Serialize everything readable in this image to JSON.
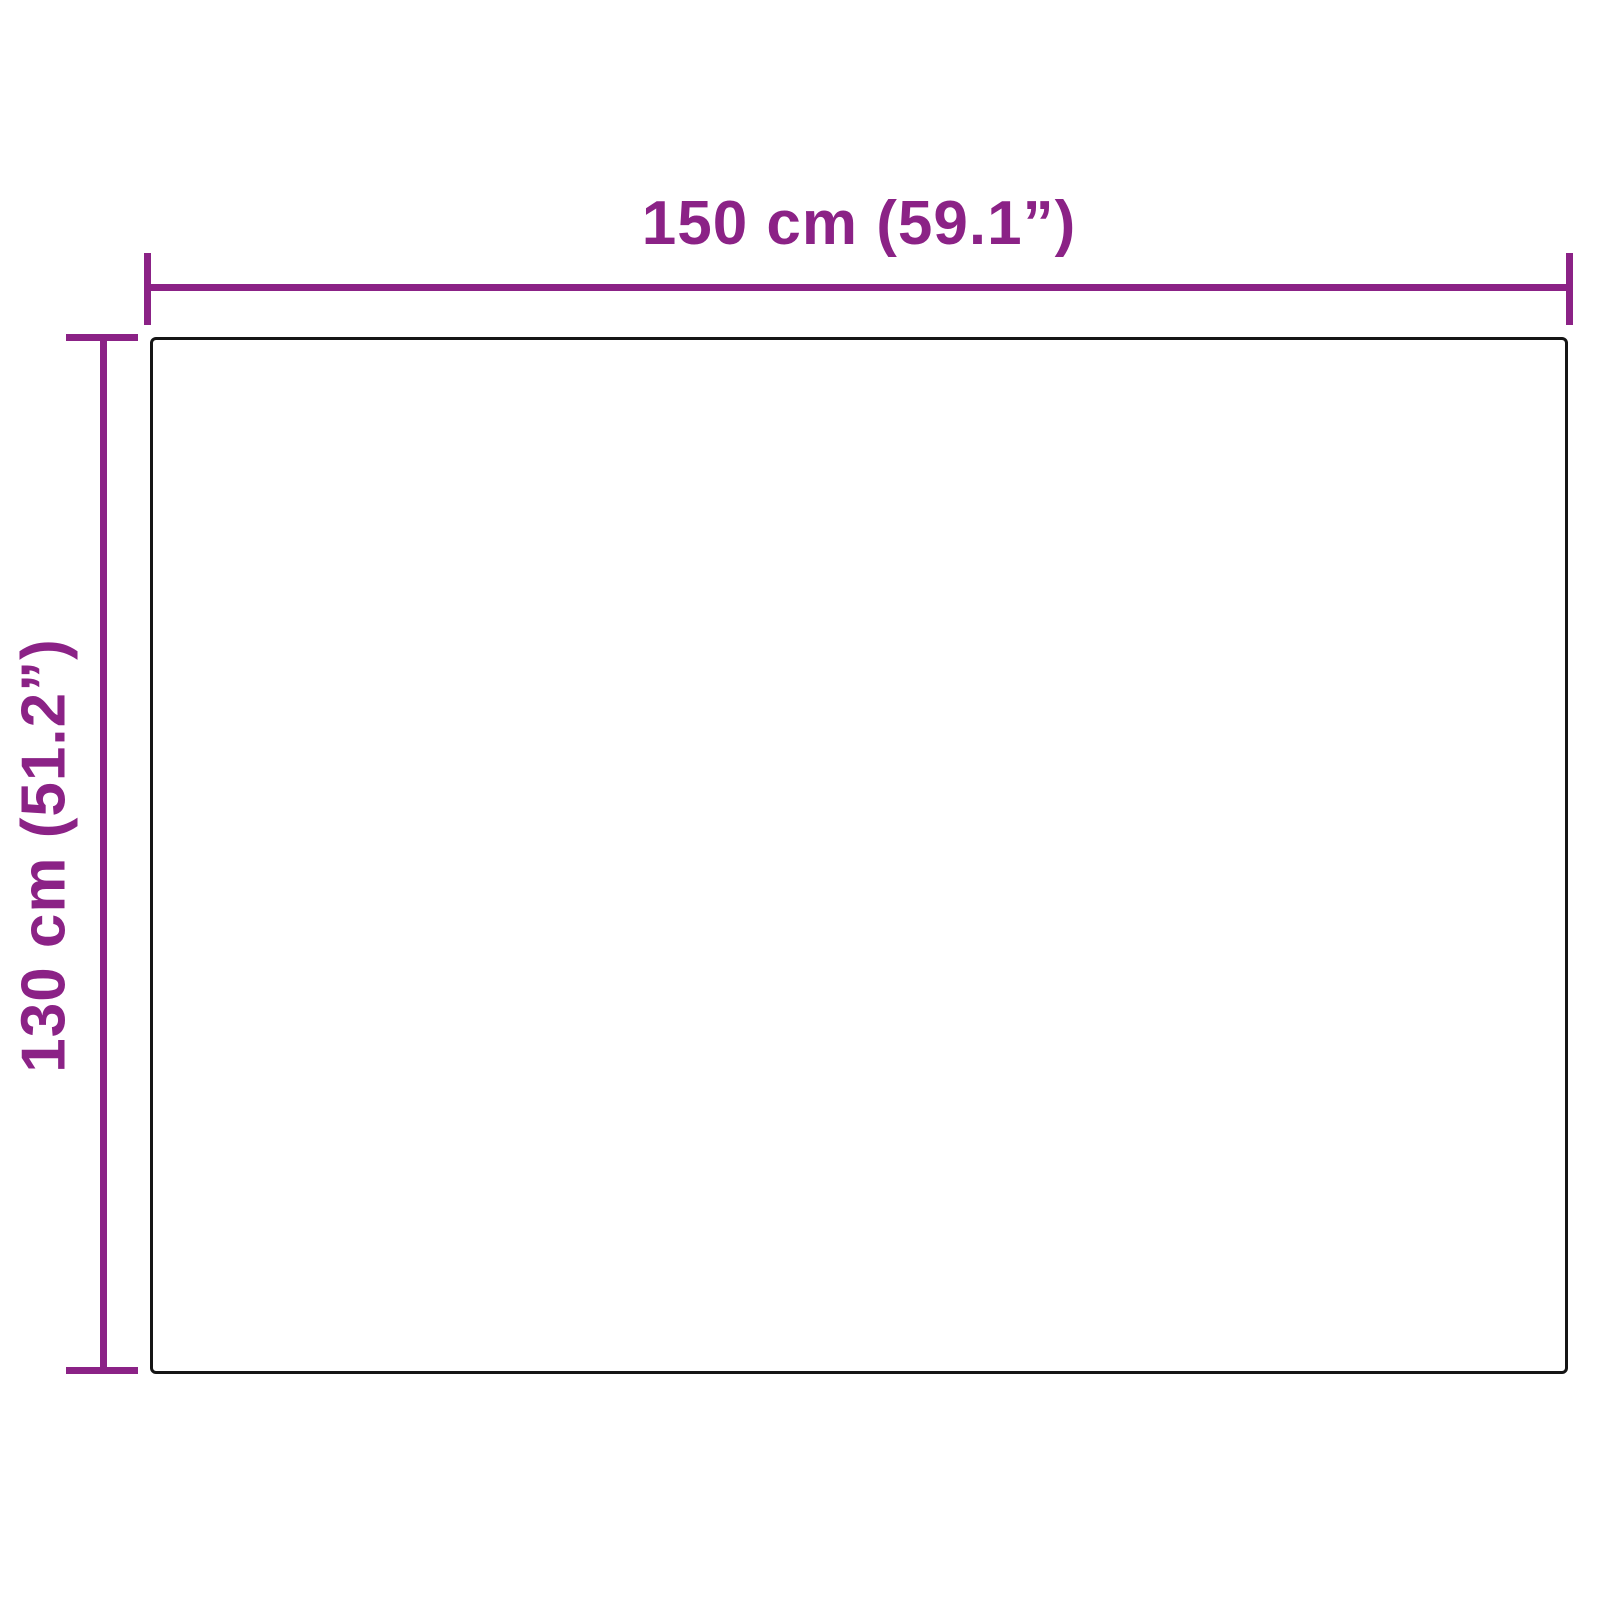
{
  "diagram": {
    "type": "product-dimension-diagram",
    "width_label": "150 cm (59.1”)",
    "height_label": "130 cm (51.2”)",
    "width_value_cm": 150,
    "width_value_in": 59.1,
    "height_value_cm": 130,
    "height_value_in": 51.2,
    "accent_color": "#8B2286",
    "outline_color": "#151515",
    "background_color": "#ffffff"
  }
}
